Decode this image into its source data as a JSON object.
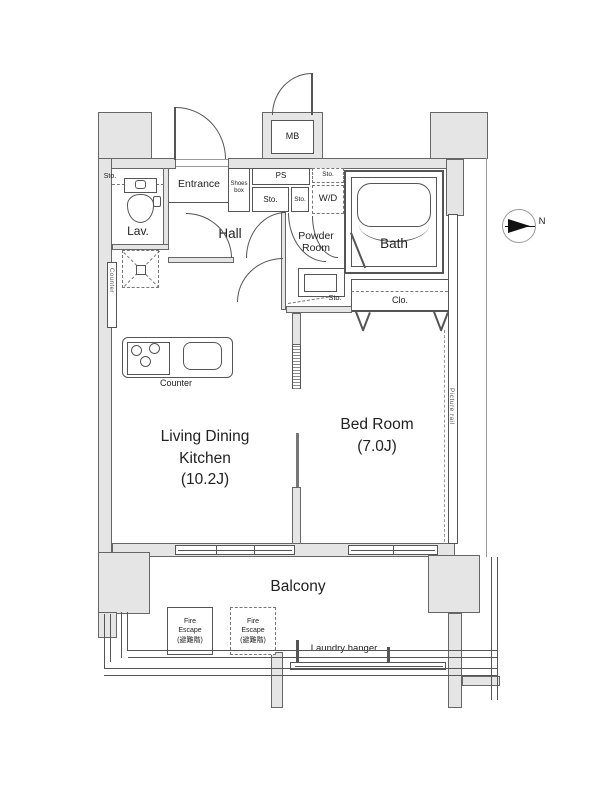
{
  "rooms": {
    "entrance": {
      "label": "Entrance"
    },
    "shoes_box": {
      "line1": "Shoes",
      "line2": "box"
    },
    "hall": {
      "label": "Hall"
    },
    "lav": {
      "label": "Lav."
    },
    "powder_room": {
      "line1": "Powder",
      "line2": "Room"
    },
    "bath": {
      "label": "Bath"
    },
    "ldk": {
      "line1": "Living Dining",
      "line2": "Kitchen",
      "line3": "(10.2J)"
    },
    "bedroom": {
      "line1": "Bed Room",
      "line2": "(7.0J)"
    },
    "balcony": {
      "label": "Balcony"
    }
  },
  "labels": {
    "mb": "MB",
    "ps": "PS",
    "sto": "Sto.",
    "wd": "W/D",
    "clo": "Clo.",
    "counter": "Counter",
    "counter_side": "Counter",
    "picture_rail": "Picture rail",
    "laundry_hanger": "Laundry hanger",
    "north": "N"
  },
  "fire_escape": {
    "line1": "Fire",
    "line2": "Escape",
    "line3": "(避難階)"
  },
  "colors": {
    "wall_fill": "#e5e5e5",
    "line": "#555555",
    "text": "#222222",
    "background": "#ffffff"
  }
}
